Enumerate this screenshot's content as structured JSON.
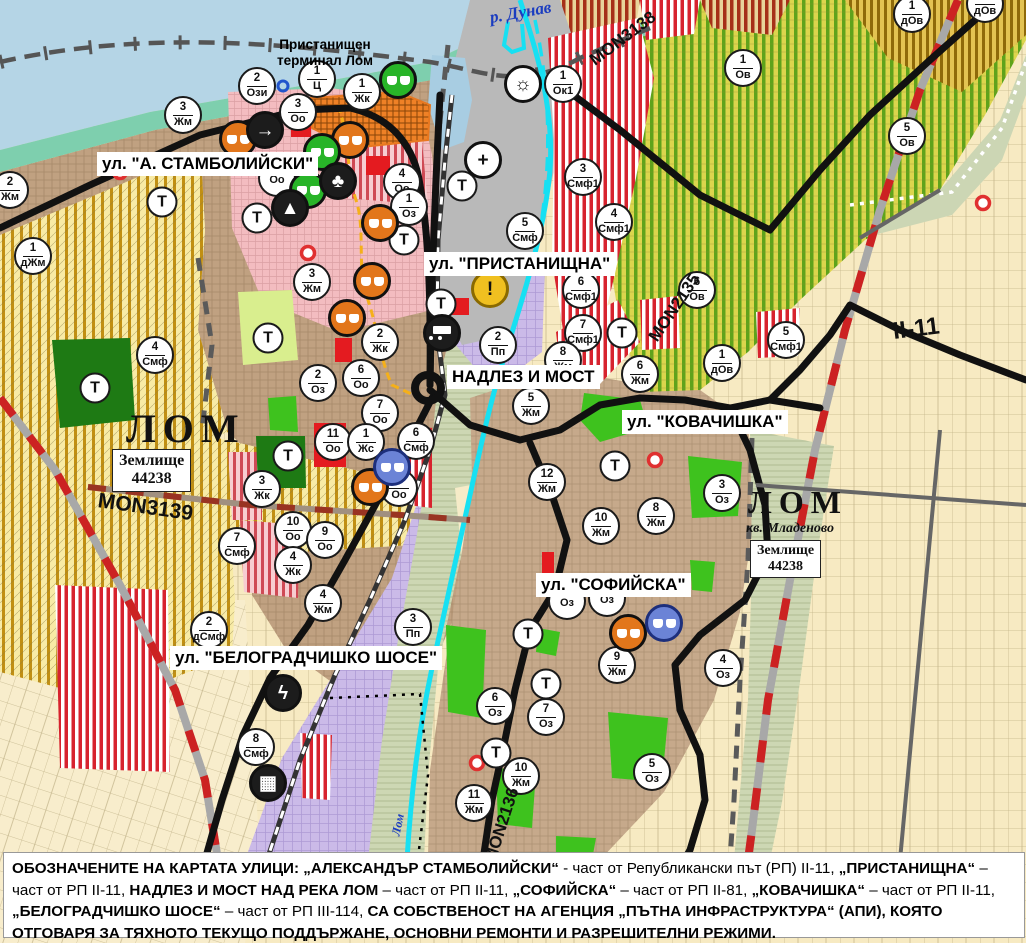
{
  "map": {
    "water_labels": {
      "danube": "р. Дунав",
      "lom_river": "Лом"
    },
    "port_label_lines": [
      "Пристанищен",
      "терминал Лом"
    ],
    "place_labels": {
      "town_left": "ЛОМ",
      "town_right": "ЛОМ",
      "district_right": "кв. Младеново",
      "land_unit_left": [
        "Землище",
        "44238"
      ],
      "land_unit_right": [
        "Землище",
        "44238"
      ]
    },
    "street_labels": [
      {
        "text": "ул. \"А. СТАМБОЛИЙСКИ\"",
        "x": 97,
        "y": 152
      },
      {
        "text": "ул. \"ПРИСТАНИЩНА\"",
        "x": 424,
        "y": 252
      },
      {
        "text": "НАДЛЕЗ И МОСТ",
        "x": 447,
        "y": 365
      },
      {
        "text": "ул. \"КОВАЧИШКА\"",
        "x": 622,
        "y": 410
      },
      {
        "text": "ул. \"СОФИЙСКА\"",
        "x": 536,
        "y": 573
      },
      {
        "text": "ул. \"БЕЛОГРАДЧИШКО ШОСЕ\"",
        "x": 170,
        "y": 646
      }
    ],
    "road_labels": [
      {
        "text": "MON3139",
        "x": 98,
        "y": 489,
        "fs": 21,
        "rot": 8
      },
      {
        "text": "MON3138",
        "x": 592,
        "y": 52,
        "fs": 17,
        "rot": -37
      },
      {
        "text": "MON2135",
        "x": 653,
        "y": 330,
        "fs": 17,
        "rot": -56
      },
      {
        "text": "MON2136",
        "x": 490,
        "y": 852,
        "fs": 17,
        "rot": -72
      },
      {
        "text": "II-11",
        "x": 893,
        "y": 318,
        "fs": 24,
        "rot": -7
      }
    ],
    "t_label": "Т",
    "markers": [
      {
        "x": 257,
        "y": 86,
        "n": "2",
        "c": "Ози"
      },
      {
        "x": 317,
        "y": 79,
        "n": "1",
        "c": "Ц"
      },
      {
        "x": 298,
        "y": 112,
        "n": "3",
        "c": "Оо"
      },
      {
        "x": 362,
        "y": 92,
        "n": "1",
        "c": "Жк"
      },
      {
        "x": 563,
        "y": 84,
        "n": "1",
        "c": "Ок1"
      },
      {
        "x": 743,
        "y": 68,
        "n": "1",
        "c": "Ов"
      },
      {
        "x": 912,
        "y": 14,
        "n": "1",
        "c": "дОв"
      },
      {
        "x": 985,
        "y": 4,
        "n": "1",
        "c": "дОв"
      },
      {
        "x": 907,
        "y": 136,
        "n": "5",
        "c": "Ов"
      },
      {
        "x": 10,
        "y": 190,
        "n": "2",
        "c": "Жм"
      },
      {
        "x": 183,
        "y": 115,
        "n": "3",
        "c": "Жм"
      },
      {
        "x": 33,
        "y": 256,
        "n": "1",
        "c": "дЖм"
      },
      {
        "x": 155,
        "y": 355,
        "n": "4",
        "c": "Смф"
      },
      {
        "x": 402,
        "y": 182,
        "n": "4",
        "c": "Оо"
      },
      {
        "x": 409,
        "y": 207,
        "n": "1",
        "c": "Оз"
      },
      {
        "x": 525,
        "y": 231,
        "n": "5",
        "c": "Смф"
      },
      {
        "x": 583,
        "y": 177,
        "n": "3",
        "c": "Смф1"
      },
      {
        "x": 614,
        "y": 222,
        "n": "4",
        "c": "Смф1"
      },
      {
        "x": 697,
        "y": 290,
        "n": "6",
        "c": "Ов"
      },
      {
        "x": 581,
        "y": 290,
        "n": "6",
        "c": "Смф1"
      },
      {
        "x": 583,
        "y": 333,
        "n": "7",
        "c": "Смф1"
      },
      {
        "x": 786,
        "y": 340,
        "n": "5",
        "c": "Смф1"
      },
      {
        "x": 722,
        "y": 363,
        "n": "1",
        "c": "дОв"
      },
      {
        "x": 498,
        "y": 345,
        "n": "2",
        "c": "Пп"
      },
      {
        "x": 277,
        "y": 178,
        "n": "",
        "c": "Оо"
      },
      {
        "x": 312,
        "y": 282,
        "n": "3",
        "c": "Жм"
      },
      {
        "x": 380,
        "y": 342,
        "n": "2",
        "c": "Жк"
      },
      {
        "x": 318,
        "y": 383,
        "n": "2",
        "c": "Оз"
      },
      {
        "x": 361,
        "y": 378,
        "n": "6",
        "c": "Оо"
      },
      {
        "x": 380,
        "y": 413,
        "n": "7",
        "c": "Оо"
      },
      {
        "x": 333,
        "y": 442,
        "n": "11",
        "c": "Оо"
      },
      {
        "x": 366,
        "y": 442,
        "n": "1",
        "c": "Жс"
      },
      {
        "x": 416,
        "y": 441,
        "n": "6",
        "c": "Смф"
      },
      {
        "x": 399,
        "y": 488,
        "n": "8",
        "c": "Оо"
      },
      {
        "x": 262,
        "y": 489,
        "n": "3",
        "c": "Жк"
      },
      {
        "x": 293,
        "y": 530,
        "n": "10",
        "c": "Оо"
      },
      {
        "x": 325,
        "y": 540,
        "n": "9",
        "c": "Оо"
      },
      {
        "x": 237,
        "y": 546,
        "n": "7",
        "c": "Смф"
      },
      {
        "x": 293,
        "y": 565,
        "n": "4",
        "c": "Жк"
      },
      {
        "x": 323,
        "y": 603,
        "n": "4",
        "c": "Жм"
      },
      {
        "x": 209,
        "y": 630,
        "n": "2",
        "c": "дСмф"
      },
      {
        "x": 413,
        "y": 627,
        "n": "3",
        "c": "Пп"
      },
      {
        "x": 256,
        "y": 747,
        "n": "8",
        "c": "Смф"
      },
      {
        "x": 563,
        "y": 360,
        "n": "8",
        "c": "Жм"
      },
      {
        "x": 640,
        "y": 374,
        "n": "6",
        "c": "Жм"
      },
      {
        "x": 531,
        "y": 406,
        "n": "5",
        "c": "Жм"
      },
      {
        "x": 547,
        "y": 482,
        "n": "12",
        "c": "Жм"
      },
      {
        "x": 601,
        "y": 526,
        "n": "10",
        "c": "Жм"
      },
      {
        "x": 656,
        "y": 516,
        "n": "8",
        "c": "Жм"
      },
      {
        "x": 722,
        "y": 493,
        "n": "3",
        "c": "Оз"
      },
      {
        "x": 567,
        "y": 601,
        "n": "",
        "c": "Оз"
      },
      {
        "x": 607,
        "y": 598,
        "n": "",
        "c": "Оз"
      },
      {
        "x": 617,
        "y": 665,
        "n": "9",
        "c": "Жм"
      },
      {
        "x": 723,
        "y": 668,
        "n": "4",
        "c": "Оз"
      },
      {
        "x": 495,
        "y": 706,
        "n": "6",
        "c": "Оз"
      },
      {
        "x": 546,
        "y": 717,
        "n": "7",
        "c": "Оз"
      },
      {
        "x": 652,
        "y": 772,
        "n": "5",
        "c": "Оз"
      },
      {
        "x": 521,
        "y": 776,
        "n": "10",
        "c": "Жм"
      },
      {
        "x": 474,
        "y": 803,
        "n": "11",
        "c": "Жм"
      }
    ],
    "t_markers": [
      {
        "x": 162,
        "y": 202
      },
      {
        "x": 257,
        "y": 218
      },
      {
        "x": 95,
        "y": 388
      },
      {
        "x": 268,
        "y": 338
      },
      {
        "x": 288,
        "y": 456
      },
      {
        "x": 404,
        "y": 240
      },
      {
        "x": 462,
        "y": 186
      },
      {
        "x": 441,
        "y": 304
      },
      {
        "x": 622,
        "y": 333
      },
      {
        "x": 615,
        "y": 466
      },
      {
        "x": 528,
        "y": 634
      },
      {
        "x": 546,
        "y": 684
      },
      {
        "x": 496,
        "y": 753
      }
    ],
    "icons": [
      {
        "x": 398,
        "y": 80,
        "type": "theatre-mask",
        "bg": "green"
      },
      {
        "x": 238,
        "y": 139,
        "type": "theatre-mask",
        "bg": "orange"
      },
      {
        "x": 265,
        "y": 130,
        "type": "one-way-arrow",
        "bg": "black"
      },
      {
        "x": 350,
        "y": 140,
        "type": "theatre-mask",
        "bg": "orange"
      },
      {
        "x": 322,
        "y": 152,
        "type": "theatre-mask",
        "bg": "green"
      },
      {
        "x": 308,
        "y": 190,
        "type": "theatre-mask",
        "bg": "green"
      },
      {
        "x": 338,
        "y": 181,
        "type": "park-club",
        "bg": "black"
      },
      {
        "x": 290,
        "y": 208,
        "type": "monument-arch",
        "bg": "black"
      },
      {
        "x": 380,
        "y": 223,
        "type": "theatre-mask",
        "bg": "orange"
      },
      {
        "x": 372,
        "y": 281,
        "type": "theatre-mask",
        "bg": "orange"
      },
      {
        "x": 347,
        "y": 318,
        "type": "theatre-mask",
        "bg": "orange"
      },
      {
        "x": 370,
        "y": 487,
        "type": "theatre-mask",
        "bg": "orange"
      },
      {
        "x": 392,
        "y": 467,
        "type": "theatre-mask",
        "bg": "blue"
      },
      {
        "x": 483,
        "y": 160,
        "type": "port-cross",
        "bg": "white"
      },
      {
        "x": 523,
        "y": 84,
        "type": "lighthouse-sun",
        "bg": "white"
      },
      {
        "x": 490,
        "y": 289,
        "type": "warning",
        "bg": "yellow"
      },
      {
        "x": 442,
        "y": 333,
        "type": "truck-terminal",
        "bg": "black"
      },
      {
        "x": 283,
        "y": 693,
        "type": "power-bolt",
        "bg": "black"
      },
      {
        "x": 268,
        "y": 783,
        "type": "rail-crossing",
        "bg": "black"
      },
      {
        "x": 628,
        "y": 633,
        "type": "theatre-mask",
        "bg": "orange"
      },
      {
        "x": 664,
        "y": 623,
        "type": "theatre-mask",
        "bg": "blue"
      }
    ],
    "icon_glyphs": {
      "one-way-arrow": "→",
      "park-club": "♣",
      "monument-arch": "▲",
      "port-cross": "+",
      "lighthouse-sun": "☼",
      "warning": "!",
      "power-bolt": "ϟ",
      "rail-crossing": "▦"
    },
    "notice_segments": [
      {
        "t": "ОБОЗНАЧЕНИТЕ НА КАРТАТА УЛИЦИ: „АЛЕКСАНДЪР СТАМБОЛИЙСКИ“",
        "b": true
      },
      {
        "t": " - част от Републикански път (РП) II-11, ",
        "b": false
      },
      {
        "t": "„ПРИСТАНИЩНА“",
        "b": true
      },
      {
        "t": " – част от РП II-11, ",
        "b": false
      },
      {
        "t": "НАДЛЕЗ И МОСТ НАД РЕКА ЛОМ",
        "b": true
      },
      {
        "t": " – част от РП II-11, ",
        "b": false
      },
      {
        "t": "„СОФИЙСКА“",
        "b": true
      },
      {
        "t": " – част от РП II-81, ",
        "b": false
      },
      {
        "t": "„КОВАЧИШКА“",
        "b": true
      },
      {
        "t": " – част от РП II-11, ",
        "b": false
      },
      {
        "t": "„БЕЛОГРАДЧИШКО ШОСЕ“",
        "b": true
      },
      {
        "t": " – част от РП III-114, ",
        "b": false
      },
      {
        "t": "СА СОБСТВЕНОСТ НА АГЕНЦИЯ „ПЪТНА ИНФРАСТРУКТУРА“ (АПИ), КОЯТО ОТГОВАРЯ ЗА ТЯХНОТО ТЕКУЩО ПОДДЪРЖАНЕ, ОСНОВНИ РЕМОНТИ И РАЗРЕШИТЕЛНИ РЕЖИМИ.",
        "b": true
      }
    ],
    "colors": {
      "water": "#b5d5e6",
      "shore": "#7ecfae",
      "port_gray": "#b9b9b9",
      "residential_brown": "#c0a181",
      "vineyard_yellow": "#f8eba6",
      "orchard_green": "#dcd54d",
      "industrial_purple": "#cbbae8",
      "farmland_cream": "#f7eac2",
      "park_green": "#1e7a14",
      "green_zone": "#3ec21e",
      "mixed_red_stripe": "#d7232e",
      "river_cyan": "#17e0f2",
      "center_pink": "#f3bcc0",
      "road_black": "#111111",
      "rail_red_dash": "#cc2222"
    }
  }
}
